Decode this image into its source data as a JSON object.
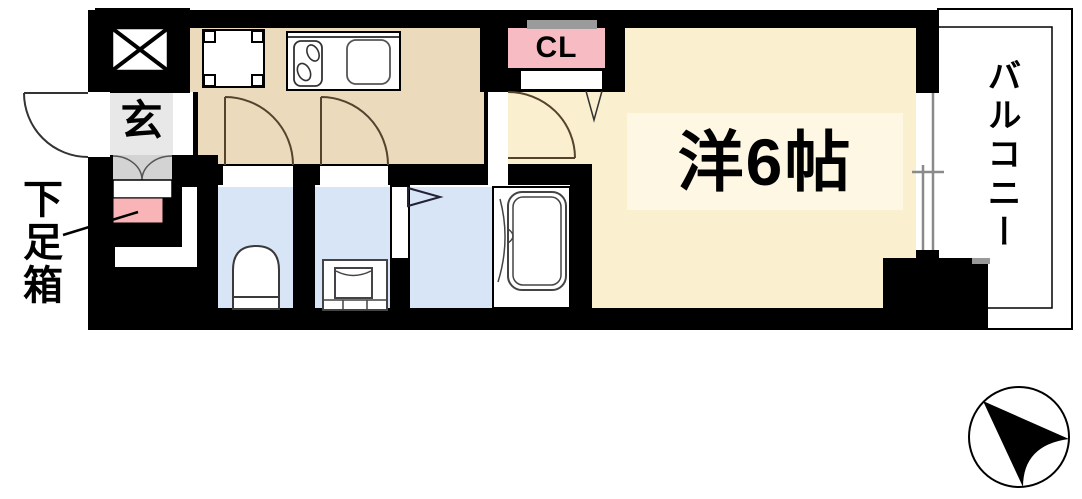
{
  "labels": {
    "entrance": "玄",
    "shoe_box": "下足箱",
    "closet": "CL",
    "main_room": "洋6帖",
    "balcony": "バルコニー"
  },
  "colors": {
    "wall": "#000000",
    "room": "#FAEFCE",
    "room_label_bg": "#FDF7E4",
    "hallway": "#EBDABC",
    "wet_room": "#D7E5F6",
    "closet_pink": "#F7BCC3",
    "closet_top_gray": "#9B9B9B",
    "shoe_box_pink": "#F8B4B6",
    "entrance_gray": "#E8E8E8",
    "entrance_step_gray": "#D3D3D3",
    "window_gray": "#8A8A8A",
    "balcony_divider_gray": "#999999",
    "door_arc": "#54432D",
    "fixture_stroke": "#3A3A3A"
  }
}
